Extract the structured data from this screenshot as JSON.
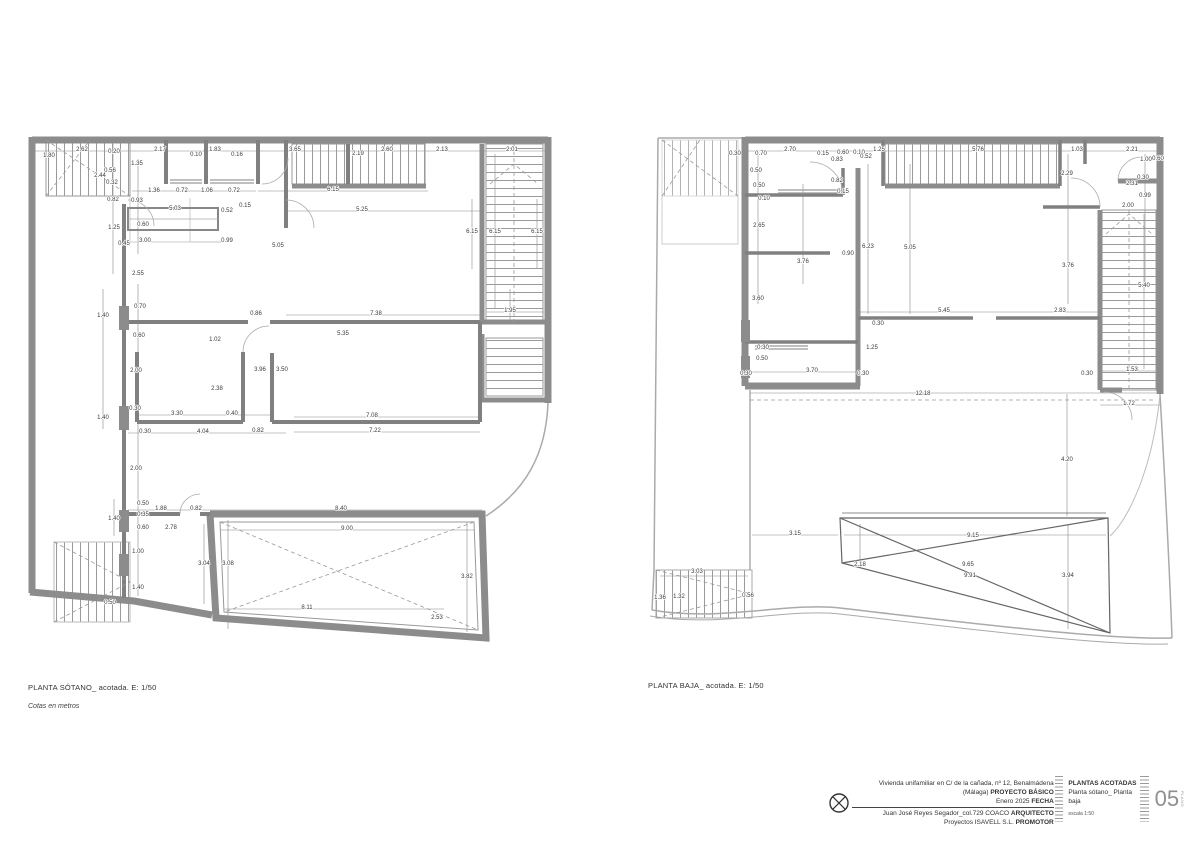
{
  "colors": {
    "wall": "#8c8c8c",
    "interior_wall": "#808080",
    "thin_line": "#aaaaaa",
    "dim_line": "#777777",
    "dim_text": "#3a3a3a"
  },
  "plans": [
    {
      "svg": "svg-sotano",
      "label": "PLANTA SÓTANO_ acotada. E: 1/50",
      "sublabel": "Cotas en metros",
      "dims": [
        [
          58,
          27,
          "2.62"
        ],
        [
          90,
          29,
          "0.20"
        ],
        [
          25,
          33,
          "1.80"
        ],
        [
          136,
          27,
          "2.17"
        ],
        [
          191,
          27,
          "1.83"
        ],
        [
          172,
          32,
          "0.10"
        ],
        [
          213,
          32,
          "0.16"
        ],
        [
          271,
          27,
          "3.65"
        ],
        [
          113,
          41,
          "1.35"
        ],
        [
          86,
          48,
          "0.56"
        ],
        [
          76,
          53,
          "2.44"
        ],
        [
          88,
          60,
          "0.32"
        ],
        [
          89,
          77,
          "0.82"
        ],
        [
          113,
          78,
          "0.93"
        ],
        [
          130,
          68,
          "1.36"
        ],
        [
          158,
          68,
          "0.72"
        ],
        [
          183,
          68,
          "1.06"
        ],
        [
          210,
          68,
          "0.72"
        ],
        [
          151,
          86,
          "5.03"
        ],
        [
          203,
          88,
          "0.52"
        ],
        [
          221,
          83,
          "0.15"
        ],
        [
          119,
          102,
          "0.60"
        ],
        [
          90,
          105,
          "1.25"
        ],
        [
          121,
          118,
          "3.00"
        ],
        [
          100,
          121,
          "0.45"
        ],
        [
          203,
          118,
          "0.99"
        ],
        [
          254,
          123,
          "5.05"
        ],
        [
          114,
          151,
          "2.55"
        ],
        [
          334,
          31,
          "2.19"
        ],
        [
          363,
          27,
          "2.60"
        ],
        [
          418,
          27,
          "2.13"
        ],
        [
          488,
          27,
          "2.01"
        ],
        [
          309,
          67,
          "6.15"
        ],
        [
          338,
          87,
          "5.25"
        ],
        [
          448,
          109,
          "6.15"
        ],
        [
          471,
          109,
          "6.15"
        ],
        [
          513,
          109,
          "6.15"
        ],
        [
          352,
          191,
          "7.38"
        ],
        [
          486,
          188,
          "1.95"
        ],
        [
          116,
          184,
          "0.70"
        ],
        [
          79,
          193,
          "1.40"
        ],
        [
          115,
          213,
          "0.60"
        ],
        [
          232,
          191,
          "0.86"
        ],
        [
          191,
          217,
          "1.02"
        ],
        [
          319,
          211,
          "5.35"
        ],
        [
          112,
          248,
          "2.00"
        ],
        [
          236,
          247,
          "3.96"
        ],
        [
          258,
          247,
          "3.50"
        ],
        [
          193,
          266,
          "2.38"
        ],
        [
          111,
          286,
          "0.30"
        ],
        [
          153,
          291,
          "3.30"
        ],
        [
          208,
          291,
          "0.40"
        ],
        [
          348,
          293,
          "7.08"
        ],
        [
          79,
          295,
          "1.40"
        ],
        [
          121,
          309,
          "0.30"
        ],
        [
          179,
          309,
          "4.04"
        ],
        [
          234,
          308,
          "0.82"
        ],
        [
          351,
          308,
          "7.22"
        ],
        [
          112,
          346,
          "2.00"
        ],
        [
          119,
          381,
          "0.50"
        ],
        [
          137,
          386,
          "1.88"
        ],
        [
          172,
          386,
          "0.82"
        ],
        [
          317,
          386,
          "8.40"
        ],
        [
          90,
          396,
          "1.40"
        ],
        [
          119,
          392,
          "0.35"
        ],
        [
          119,
          405,
          "0.60"
        ],
        [
          147,
          405,
          "2.78"
        ],
        [
          323,
          406,
          "9.00"
        ],
        [
          114,
          429,
          "1.00"
        ],
        [
          180,
          441,
          "3.04"
        ],
        [
          204,
          441,
          "3.08"
        ],
        [
          114,
          465,
          "1.40"
        ],
        [
          86,
          480,
          "0.50"
        ],
        [
          283,
          485,
          "8.11"
        ],
        [
          413,
          495,
          "2.53"
        ],
        [
          443,
          454,
          "3.82"
        ]
      ]
    },
    {
      "svg": "svg-baja",
      "label": "PLANTA BAJA_ acotada. E: 1/50",
      "sublabel": "",
      "dims": [
        [
          87,
          31,
          "0.30"
        ],
        [
          113,
          31,
          "0.70"
        ],
        [
          142,
          27,
          "2.70"
        ],
        [
          175,
          31,
          "0.15"
        ],
        [
          195,
          30,
          "0.60"
        ],
        [
          211,
          30,
          "0.10"
        ],
        [
          231,
          27,
          "1.25"
        ],
        [
          189,
          37,
          "0.83"
        ],
        [
          218,
          34,
          "0.52"
        ],
        [
          108,
          48,
          "0.50"
        ],
        [
          111,
          63,
          "0.50"
        ],
        [
          189,
          58,
          "0.82"
        ],
        [
          195,
          69,
          "0.15"
        ],
        [
          116,
          76,
          "0.10"
        ],
        [
          111,
          103,
          "2.65"
        ],
        [
          220,
          124,
          "6.23"
        ],
        [
          262,
          125,
          "5.05"
        ],
        [
          200,
          131,
          "0.90"
        ],
        [
          155,
          139,
          "3.76"
        ],
        [
          110,
          176,
          "3.60"
        ],
        [
          330,
          27,
          "5.76"
        ],
        [
          429,
          27,
          "1.03"
        ],
        [
          484,
          27,
          "2.21"
        ],
        [
          498,
          37,
          "1.00"
        ],
        [
          510,
          36,
          "0.60"
        ],
        [
          419,
          51,
          "2.29"
        ],
        [
          495,
          55,
          "0.30"
        ],
        [
          484,
          61,
          "2.31"
        ],
        [
          497,
          73,
          "0.99"
        ],
        [
          480,
          83,
          "2.00"
        ],
        [
          420,
          143,
          "3.76"
        ],
        [
          496,
          163,
          "5.40"
        ],
        [
          296,
          188,
          "5.45"
        ],
        [
          412,
          188,
          "2.83"
        ],
        [
          115,
          225,
          "0.30"
        ],
        [
          114,
          236,
          "0.50"
        ],
        [
          164,
          248,
          "3.70"
        ],
        [
          98,
          251,
          "0.30"
        ],
        [
          215,
          251,
          "0.30"
        ],
        [
          224,
          225,
          "1.25"
        ],
        [
          230,
          201,
          "0.30"
        ],
        [
          275,
          271,
          "12.18"
        ],
        [
          484,
          247,
          "1.53"
        ],
        [
          439,
          251,
          "0.30"
        ],
        [
          481,
          281,
          "1.72"
        ],
        [
          419,
          337,
          "4.20"
        ],
        [
          147,
          411,
          "3.15"
        ],
        [
          325,
          413,
          "9.15"
        ],
        [
          212,
          442,
          "2.18"
        ],
        [
          320,
          442,
          "9.65"
        ],
        [
          322,
          453,
          "9.91"
        ],
        [
          420,
          453,
          "3.94"
        ],
        [
          49,
          449,
          "3.03"
        ],
        [
          12,
          475,
          "1.36"
        ],
        [
          31,
          474,
          "1.32"
        ],
        [
          100,
          473,
          "0.56"
        ]
      ]
    }
  ],
  "titleblock": {
    "project": "Vivienda unifamiliar en C/ de la cañada, nº 12, Benalmádena (Málaga)",
    "project_label": "PROYECTO BÁSICO",
    "date": "Enero 2025",
    "date_label": "FECHA",
    "architect": "Juan José Reyes Segador_col.729 COACO",
    "architect_label": "ARQUITECTO",
    "promoter": "Proyectos ISAVELL S.L.",
    "promoter_label": "PROMOTOR",
    "sheet_title": "PLANTAS ACOTADAS",
    "sheet_subtitle": "Planta sótano_ Planta baja",
    "scale": "escala 1:50",
    "sheet_number": "05",
    "sheet_number_side": "PLANO"
  }
}
